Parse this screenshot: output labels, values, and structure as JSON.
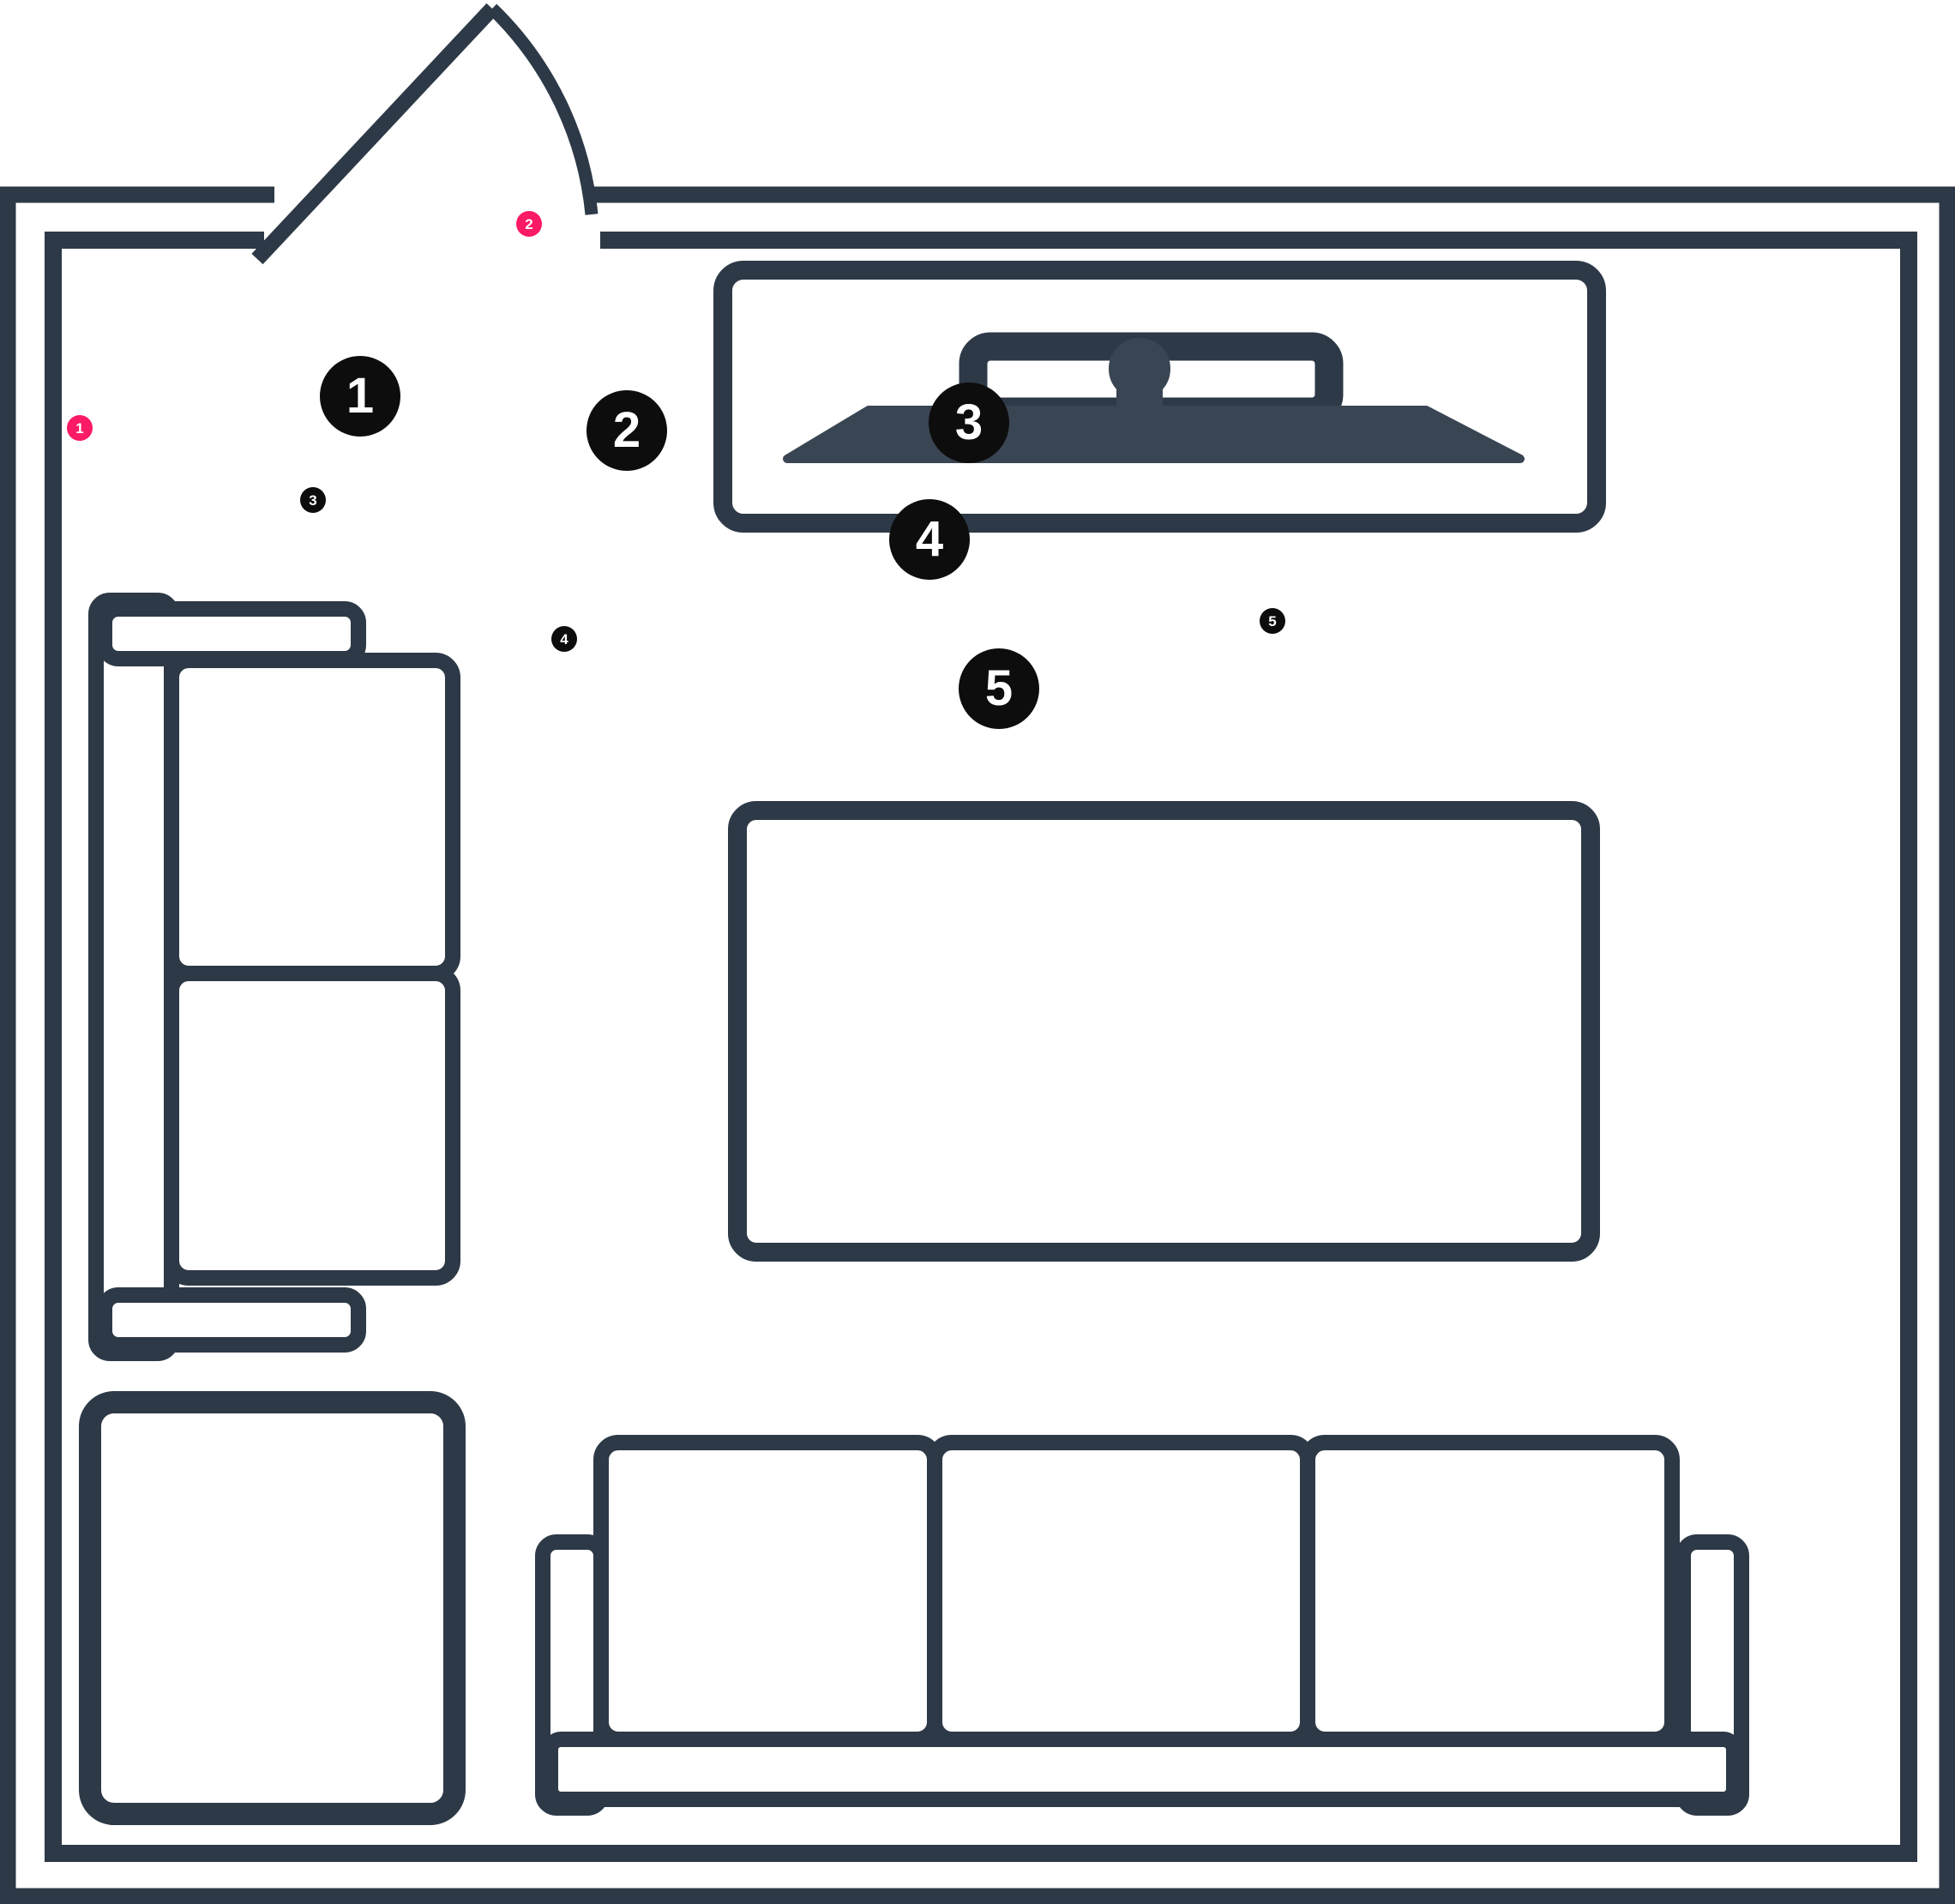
{
  "scene": {
    "title": "Living room floor plan with numbered annotation markers",
    "type": "floor-plan"
  },
  "colors": {
    "background": "#ffffff",
    "outline": "#2e3947",
    "tv_fill": "#3a4553",
    "marker_black": "#0d0d0d",
    "marker_pink": "#fa1a66",
    "marker_text": "#ffffff"
  },
  "markers": {
    "large": [
      {
        "label": "1"
      },
      {
        "label": "2"
      },
      {
        "label": "3"
      },
      {
        "label": "4"
      },
      {
        "label": "5"
      }
    ],
    "small_black": [
      {
        "label": "3"
      },
      {
        "label": "4"
      },
      {
        "label": "5"
      }
    ],
    "small_pink": [
      {
        "label": "1"
      },
      {
        "label": "2"
      }
    ]
  },
  "furniture": [
    {
      "name": "door"
    },
    {
      "name": "tv-console"
    },
    {
      "name": "two-seat-sofa"
    },
    {
      "name": "coffee-table"
    },
    {
      "name": "side-table"
    },
    {
      "name": "three-seat-sofa"
    }
  ]
}
